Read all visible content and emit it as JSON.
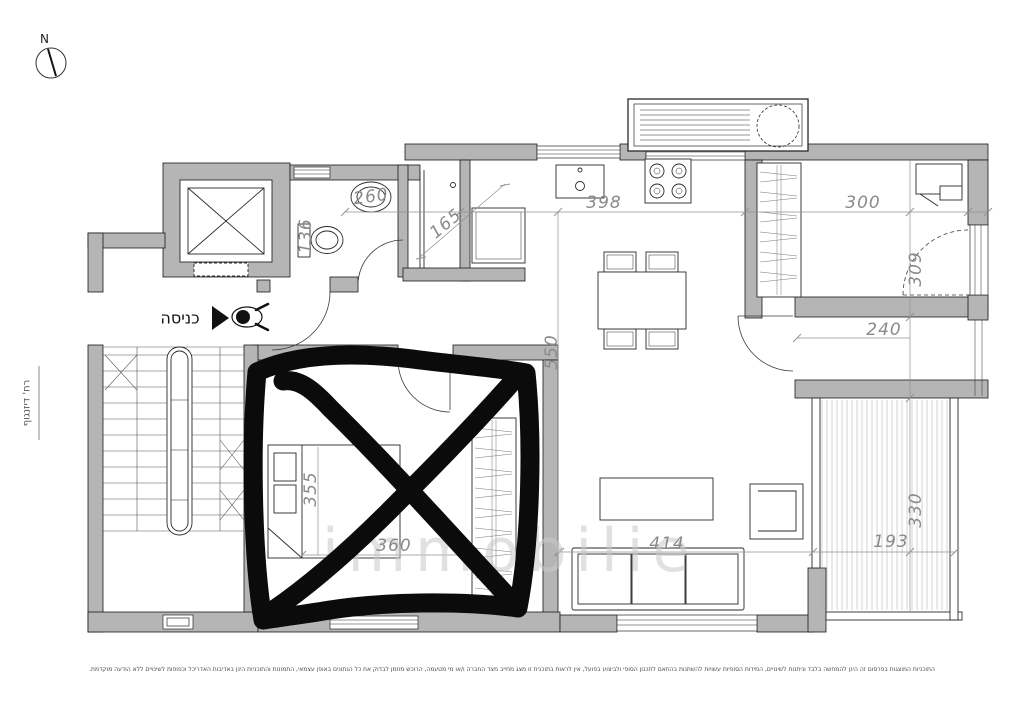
{
  "plan": {
    "compass_label": "N",
    "entrance_label": "כניסה",
    "street_label": "רח' דיזנגוף",
    "watermark": "immobilie",
    "disclaimer": "התוכניות המוצגות בפרסום זה הינן להמחשה בלבד וניתנות לשינויים, המידות הסופיות עשויות להשתנות בהתאם לתכנון הסופי ולביצוע בפועל, אין לראות בתוכנית זו מצג מחייב מצד החברה ו/או מי מטעמה, הרוכש מוזמן לבדוק את כל הנתונים באופן עצמאי, התמונות והתוכניות הינן באדיבות האדריכל וכפופות לשינויים ללא הודעה מוקדמת.",
    "dimensions": {
      "bath_sink": "260",
      "wc": "136",
      "shower": "165",
      "kitchen_width": "398",
      "living_length": "550",
      "bedroom_width": "300",
      "bedroom_depth": "309",
      "room_width": "240",
      "bed_depth": "355",
      "bed_width": "360",
      "sofa_width": "414",
      "balcony_depth": "330",
      "balcony_width": "193"
    },
    "colors": {
      "wall_fill": "#b5b5b5",
      "line": "#2a2a2a",
      "dim_text": "#8a8a8a",
      "marker": "#0b0b0b"
    }
  }
}
